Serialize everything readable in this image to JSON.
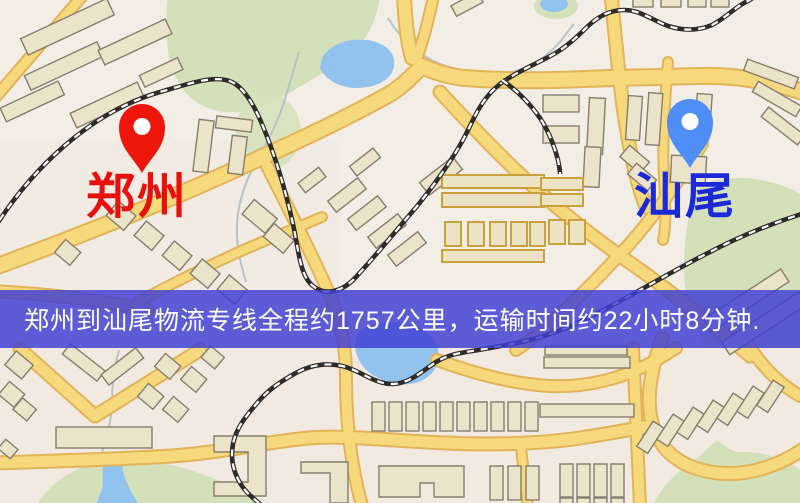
{
  "map": {
    "markers": [
      {
        "id": "origin",
        "label": "郑州",
        "pin_color": "#ee160b",
        "label_color": "#e8100a"
      },
      {
        "id": "destination",
        "label": "汕尾",
        "pin_color": "#4f8ef7",
        "label_color": "#1b29d8"
      }
    ],
    "banner": {
      "text": "郑州到汕尾物流专线全程约1757公里，运输时间约22小时8分钟.",
      "background_color": "#403fd3",
      "text_color": "#ffffff"
    },
    "route": {
      "origin": "郑州",
      "destination": "汕尾",
      "distance_km": 1757,
      "duration_text": "22小时8分钟"
    },
    "map_colors": {
      "background": "#f3eee5",
      "road": "#f6d87d",
      "road_casing": "#e2b45a",
      "park": "#d4e0ba",
      "water": "#92c3ee",
      "railway": "#2e2b28",
      "building": "#ebe3ca"
    }
  }
}
